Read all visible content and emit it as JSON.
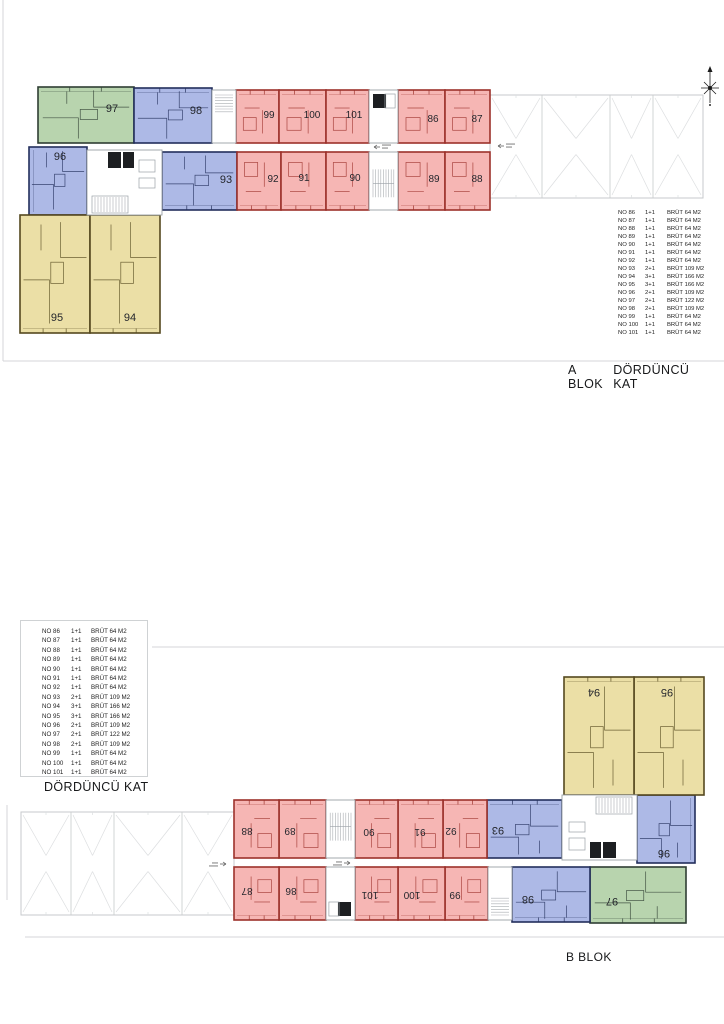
{
  "labels": {
    "block_a": "A BLOK",
    "floor_a": "DÖRDÜNCÜ KAT",
    "floor_b": "DÖRDÜNCÜ KAT",
    "block_b": "B BLOK"
  },
  "unit_list": {
    "rows": [
      {
        "no": "NO 86",
        "type": "1+1",
        "area": "BRÜT 64 M2"
      },
      {
        "no": "NO 87",
        "type": "1+1",
        "area": "BRÜT 64 M2"
      },
      {
        "no": "NO 88",
        "type": "1+1",
        "area": "BRÜT 64 M2"
      },
      {
        "no": "NO 89",
        "type": "1+1",
        "area": "BRÜT 64 M2"
      },
      {
        "no": "NO 90",
        "type": "1+1",
        "area": "BRÜT 64 M2"
      },
      {
        "no": "NO 91",
        "type": "1+1",
        "area": "BRÜT 64 M2"
      },
      {
        "no": "NO 92",
        "type": "1+1",
        "area": "BRÜT 64 M2"
      },
      {
        "no": "NO 93",
        "type": "2+1",
        "area": "BRÜT 109 M2"
      },
      {
        "no": "NO 94",
        "type": "3+1",
        "area": "BRÜT 166 M2"
      },
      {
        "no": "NO 95",
        "type": "3+1",
        "area": "BRÜT 166 M2"
      },
      {
        "no": "NO 96",
        "type": "2+1",
        "area": "BRÜT 109 M2"
      },
      {
        "no": "NO 97",
        "type": "2+1",
        "area": "BRÜT 122 M2"
      },
      {
        "no": "NO 98",
        "type": "2+1",
        "area": "BRÜT 109 M2"
      },
      {
        "no": "NO 99",
        "type": "1+1",
        "area": "BRÜT 64 M2"
      },
      {
        "no": "NO 100",
        "type": "1+1",
        "area": "BRÜT 64 M2"
      },
      {
        "no": "NO 101",
        "type": "1+1",
        "area": "BRÜT 64 M2"
      }
    ]
  },
  "palette": {
    "red_fill": "#f6b6b4",
    "red_wall": "#9c312b",
    "blue_fill": "#adb9e6",
    "blue_wall": "#232f5c",
    "green_fill": "#b8d4ae",
    "green_wall": "#2f3e33",
    "yellow_fill": "#ebdfa6",
    "yellow_wall": "#55491f",
    "core_stroke": "#9aa0a6",
    "core_dark": "#1d1f22",
    "stair_line": "#a9adb2",
    "parking_stroke": "#c7cacc",
    "parking_mark": "#dcdee0",
    "sheet_line": "#d4d6d8",
    "label": "#24262c",
    "annotation": "#8a8a8a"
  },
  "floor_plan": {
    "canvas": {
      "w": 724,
      "h": 1024
    },
    "mirror": {
      "cx": 362,
      "cy": 505
    },
    "units": [
      {
        "id": "97",
        "color": "green",
        "x": 38,
        "y": 87,
        "w": 96,
        "h": 56,
        "lx": 112,
        "ly": 112,
        "fs": 11,
        "out": "t"
      },
      {
        "id": "98",
        "color": "blue",
        "x": 134,
        "y": 88,
        "w": 78,
        "h": 55,
        "lx": 196,
        "ly": 114,
        "fs": 11,
        "out": "t"
      },
      {
        "id": "99",
        "color": "red",
        "x": 236,
        "y": 90,
        "w": 43,
        "h": 53,
        "lx": 269,
        "ly": 118,
        "fs": 10,
        "out": "t"
      },
      {
        "id": "100",
        "color": "red",
        "x": 279,
        "y": 90,
        "w": 47,
        "h": 53,
        "lx": 312,
        "ly": 118,
        "fs": 10,
        "out": "t"
      },
      {
        "id": "101",
        "color": "red",
        "x": 326,
        "y": 90,
        "w": 43,
        "h": 53,
        "lx": 354,
        "ly": 118,
        "fs": 10,
        "out": "t"
      },
      {
        "id": "86",
        "color": "red",
        "x": 398,
        "y": 90,
        "w": 47,
        "h": 53,
        "lx": 433,
        "ly": 122,
        "fs": 10,
        "out": "t"
      },
      {
        "id": "87",
        "color": "red",
        "x": 445,
        "y": 90,
        "w": 45,
        "h": 53,
        "lx": 477,
        "ly": 122,
        "fs": 10,
        "out": "t"
      },
      {
        "id": "96",
        "color": "blue",
        "x": 29,
        "y": 147,
        "w": 58,
        "h": 68,
        "lx": 60,
        "ly": 160,
        "fs": 11,
        "out": "l"
      },
      {
        "id": "93",
        "color": "blue",
        "x": 162,
        "y": 152,
        "w": 75,
        "h": 58,
        "lx": 226,
        "ly": 183,
        "fs": 11,
        "out": "b"
      },
      {
        "id": "92",
        "color": "red",
        "x": 237,
        "y": 152,
        "w": 44,
        "h": 58,
        "lx": 273,
        "ly": 182,
        "fs": 10,
        "out": "b"
      },
      {
        "id": "91",
        "color": "red",
        "x": 281,
        "y": 152,
        "w": 45,
        "h": 58,
        "lx": 304,
        "ly": 181,
        "fs": 10,
        "out": "b"
      },
      {
        "id": "90",
        "color": "red",
        "x": 326,
        "y": 152,
        "w": 43,
        "h": 58,
        "lx": 355,
        "ly": 181,
        "fs": 10,
        "out": "b"
      },
      {
        "id": "89",
        "color": "red",
        "x": 398,
        "y": 152,
        "w": 47,
        "h": 58,
        "lx": 434,
        "ly": 182,
        "fs": 10,
        "out": "b"
      },
      {
        "id": "88",
        "color": "red",
        "x": 445,
        "y": 152,
        "w": 45,
        "h": 58,
        "lx": 477,
        "ly": 182,
        "fs": 10,
        "out": "b"
      },
      {
        "id": "95",
        "color": "yellow",
        "x": 20,
        "y": 215,
        "w": 70,
        "h": 118,
        "lx": 57,
        "ly": 321,
        "fs": 11,
        "out": "b"
      },
      {
        "id": "94",
        "color": "yellow",
        "x": 90,
        "y": 215,
        "w": 70,
        "h": 118,
        "lx": 130,
        "ly": 321,
        "fs": 11,
        "out": "b"
      }
    ],
    "cores": [
      {
        "kind": "stair-h",
        "x": 212,
        "y": 90,
        "w": 24,
        "h": 53
      },
      {
        "kind": "elev",
        "x": 369,
        "y": 90,
        "w": 29,
        "h": 53
      },
      {
        "kind": "stair-v",
        "x": 369,
        "y": 152,
        "w": 29,
        "h": 58
      },
      {
        "kind": "lobby",
        "x": 87,
        "y": 150,
        "w": 75,
        "h": 65
      }
    ],
    "parking": {
      "x": 490,
      "y": 95,
      "w": 213,
      "h": 103,
      "dividers": [
        542,
        610,
        653
      ]
    },
    "annotations": [
      [
        374,
        147
      ],
      [
        498,
        146
      ]
    ],
    "compass": {
      "cx": 710,
      "cy": 88
    },
    "sheet_lines": [
      [
        3,
        0,
        3,
        361
      ],
      [
        3,
        361,
        724,
        361
      ],
      [
        152,
        647,
        724,
        647
      ],
      [
        7,
        805,
        7,
        900
      ],
      [
        25,
        937,
        724,
        937
      ]
    ]
  }
}
